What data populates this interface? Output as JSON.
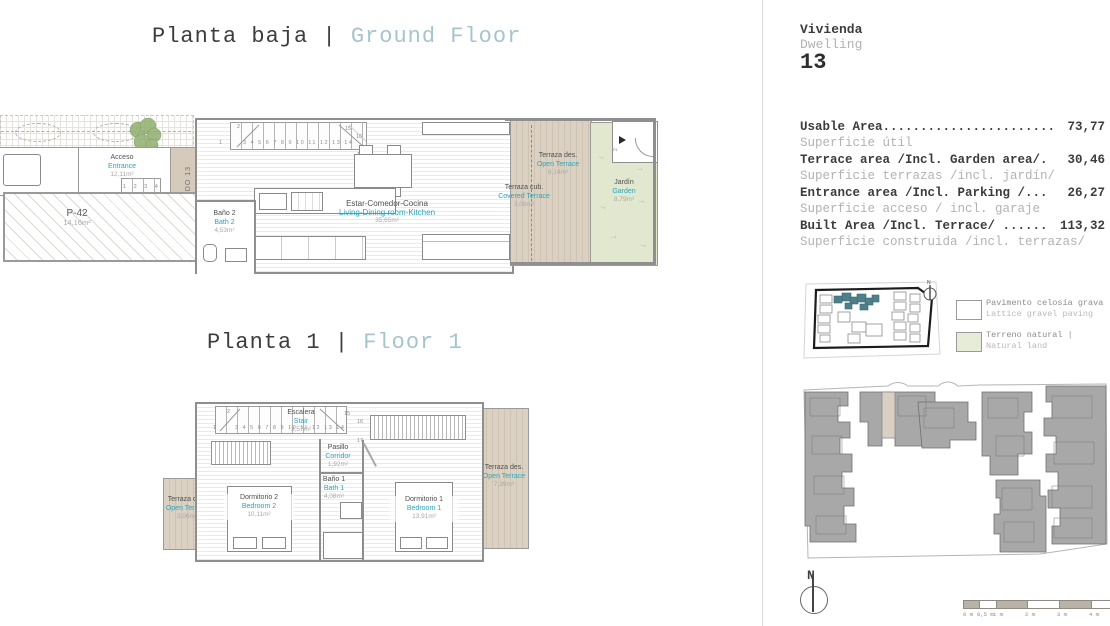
{
  "colors": {
    "accent_teal": "#2aa5bd",
    "title_blue": "#a6c4cd",
    "terrace_tan": "#d9cfc2",
    "garden_green": "#e2e8d0",
    "site_gray": "#a8a8a8",
    "highlight_teal": "#4e8089"
  },
  "titles": {
    "ground_floor": {
      "es": "Planta baja",
      "sep": "|",
      "en": "Ground Floor"
    },
    "floor_1": {
      "es": "Planta 1",
      "sep": "|",
      "en": "Floor 1"
    }
  },
  "dwelling": {
    "es": "Vivienda",
    "en": "Dwelling",
    "number": "13"
  },
  "areas": {
    "rows": [
      {
        "en": "Usable Area.......................",
        "value": "73,77",
        "es": "Superficie útil"
      },
      {
        "en": "Terrace area /Incl. Garden area/.",
        "value": "30,46",
        "es": "Superficie terrazas /incl. jardín/"
      },
      {
        "en": "Entrance area /Incl. Parking /...",
        "value": "26,27",
        "es": "Superficie acceso / incl. garaje"
      },
      {
        "en": "Built Area /Incl. Terrace/ ......",
        "value": "113,32",
        "es": "Superficie construida /incl. terrazas/"
      }
    ]
  },
  "legend": {
    "gravel": {
      "es": "Pavimento celosía grava",
      "en": "Lattice gravel paving"
    },
    "natural": {
      "es": "Terreno natural |",
      "en": "Natural land"
    }
  },
  "compass": {
    "n": "N"
  },
  "scale_bar": {
    "labels": [
      "0 m",
      "0,5 m",
      "1 m",
      "2 m",
      "3 m",
      "4 m"
    ]
  },
  "gf": {
    "acceso": {
      "es": "Acceso",
      "en": "Entrance",
      "area": "12,11m²"
    },
    "parking": {
      "name": "P-42",
      "area": "14,16m²"
    },
    "porch_tag": "ADO 13",
    "entry_steps": "1 2 3 4",
    "bath2": {
      "es": "Baño 2",
      "en": "Bath 2",
      "area": "4,53m²"
    },
    "living": {
      "es": "Estar-Comedor-Cocina",
      "en": "Living-Dining room-Kitchen",
      "area": "35,65m²"
    },
    "open_terrace": {
      "es": "Terraza des.",
      "en": "Open Terrace",
      "area": "8,14m²"
    },
    "covered_terrace": {
      "es": "Terraza cub.",
      "en": "Covered Terrace",
      "area": "3,08m²"
    },
    "garden": {
      "es": "Jardín",
      "en": "Garden",
      "area": "8,79m²"
    },
    "garden_door_step": "2",
    "stairs": {
      "n1": "1",
      "n2": "2",
      "run": "3 4 5 6 7 8 9 10 11 12 13 14",
      "n15": "15",
      "n16": "16",
      "n17": "17"
    }
  },
  "f1": {
    "stair": {
      "es": "Escalera",
      "en": "Stair",
      "area": "3,57m²"
    },
    "corridor": {
      "es": "Pasillo",
      "en": "Corridor",
      "area": "1,92m²"
    },
    "bath1": {
      "es": "Baño 1",
      "en": "Bath 1",
      "area": "4,08m²"
    },
    "bedroom2": {
      "es": "Dormitorio 2",
      "en": "Bedroom 2",
      "area": "10,11m²"
    },
    "bedroom1": {
      "es": "Dormitorio 1",
      "en": "Bedroom 1",
      "area": "13,91m²"
    },
    "terrace_left": {
      "es": "Terraza des.",
      "en": "Open Terrace",
      "area": "3,06m²"
    },
    "terrace_right": {
      "es": "Terraza des.",
      "en": "Open Terrace",
      "area": "7,39m²"
    },
    "stairs": {
      "n1": "1",
      "n2": "2",
      "run": "3 4 5 6 7 8 9 10 11 12 13 14",
      "n15": "15",
      "n16": "16",
      "n17": "17"
    }
  }
}
